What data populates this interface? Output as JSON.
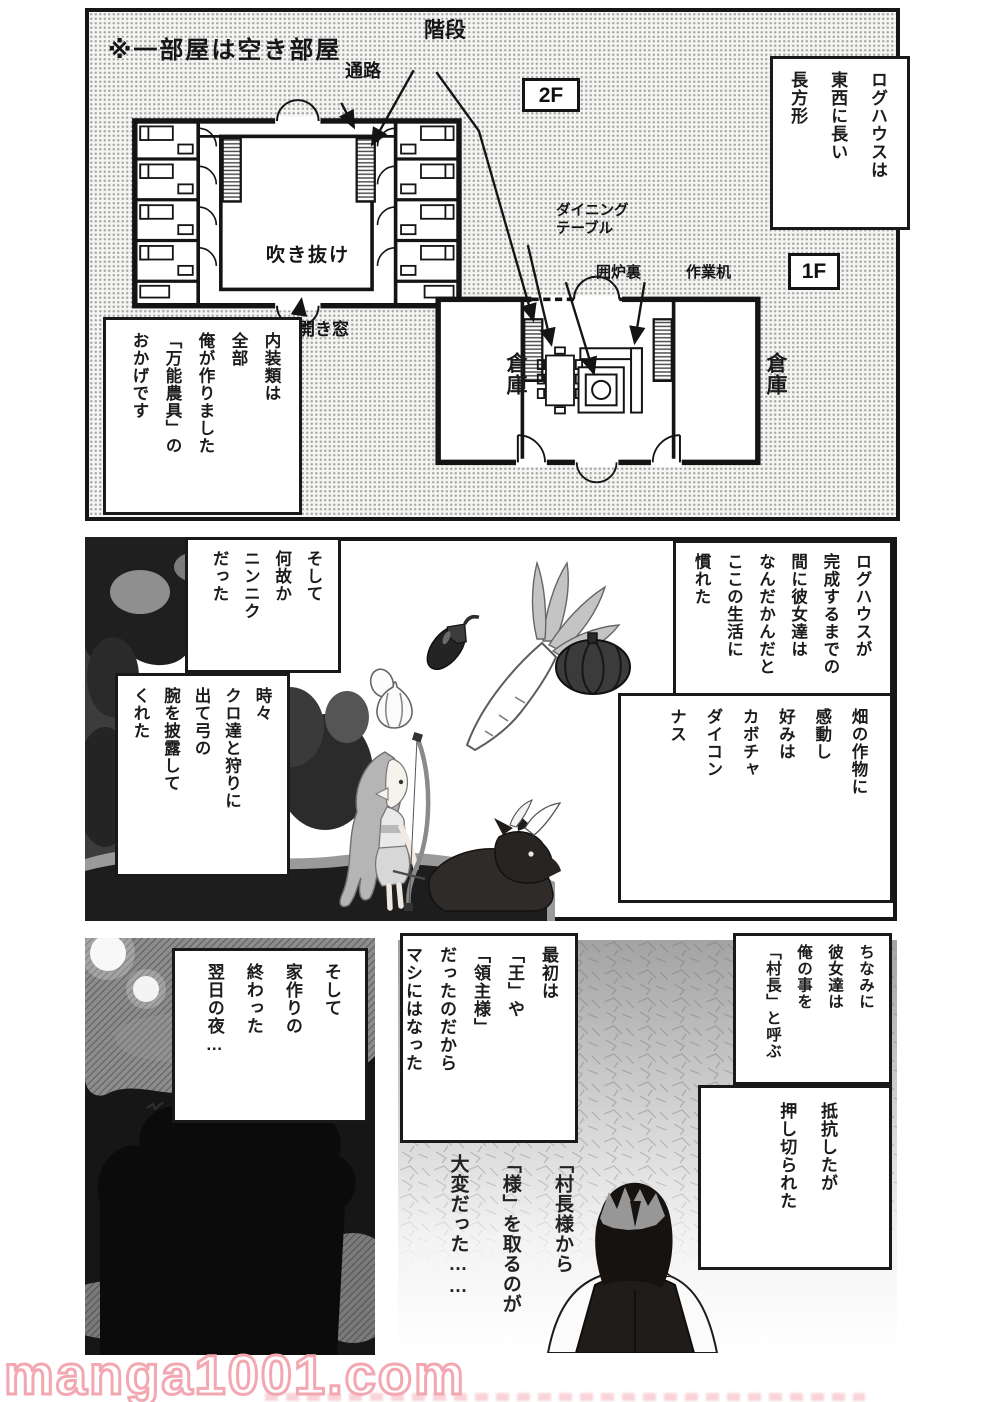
{
  "colors": {
    "watermark_outline": "#f3a8b1",
    "panel_line": "#161616"
  },
  "top_panel": {
    "note_vacant": "※一部屋は空き部屋",
    "floor2_label": "2F",
    "floor1_label": "1F",
    "label_stairs": "階段",
    "label_corridor": "通路",
    "label_atrium": "吹き抜け",
    "label_window": "開き窓",
    "label_dining_table": "ダイニング\nテーブル",
    "label_hearth": "囲炉裏",
    "label_work_desk": "作業机",
    "label_storage_left": "倉庫",
    "label_storage_right": "倉庫",
    "box_shape": {
      "text": "ログハウスは\n東西に長い\n長方形",
      "furigana": "とうざい なが ちょうほうけい"
    },
    "box_interior": {
      "text": "内装類は\n全部\n俺が作りました\n「万能農具」の\nおかげです",
      "furigana": "ないそうるい ぜんぶ おれ つく ばんのうのうぐ"
    }
  },
  "middle_panel": {
    "box_adapt": {
      "text": "ログハウスが\n完成するまでの\n間に彼女達は\nなんだかんだと\nここの生活に\n慣れた",
      "furigana": "かんせい あいだ かのじょたち せいかつ な"
    },
    "box_crops": {
      "text": "畑の作物に\n感動し\n好みは\nカボチャ\nダイコン\nナス",
      "furigana": "はたけ さくもつ かんどう この"
    },
    "box_garlic": {
      "text": "そして\n何故か\nニンニク\nだった",
      "furigana": "なぜ"
    },
    "box_hunting": {
      "text": "時々\nクロ達と狩りに\n出て弓の\n腕を披露して\nくれた",
      "furigana": "ときどき たち か で ゆみ うで ひろう"
    }
  },
  "bottom_left_panel": {
    "box_night": {
      "text": "そして\n家作りの\n終わった\n翌日の夜…",
      "furigana": "いえづく お よくじつ よる"
    }
  },
  "bottom_right_panel": {
    "box_chief": {
      "text": "ちなみに\n彼女達は\n俺の事を\n「村長」と呼ぶ",
      "furigana": "かのじょたち おれ こと そんちょう よ"
    },
    "box_resist": {
      "text": "抵抗したが\n押し切られた",
      "furigana": "ていこう お き"
    },
    "box_title": {
      "text": "最初は\n「王」や\n「領主様」\nだったのだから\nマシにはなった",
      "furigana": "さいしょ おう りょうしゅさま"
    },
    "handwritten": "「村長様から\n「様」を取るのが\n大変だった……"
  },
  "footer": {
    "watermark": "manga1001.com"
  }
}
